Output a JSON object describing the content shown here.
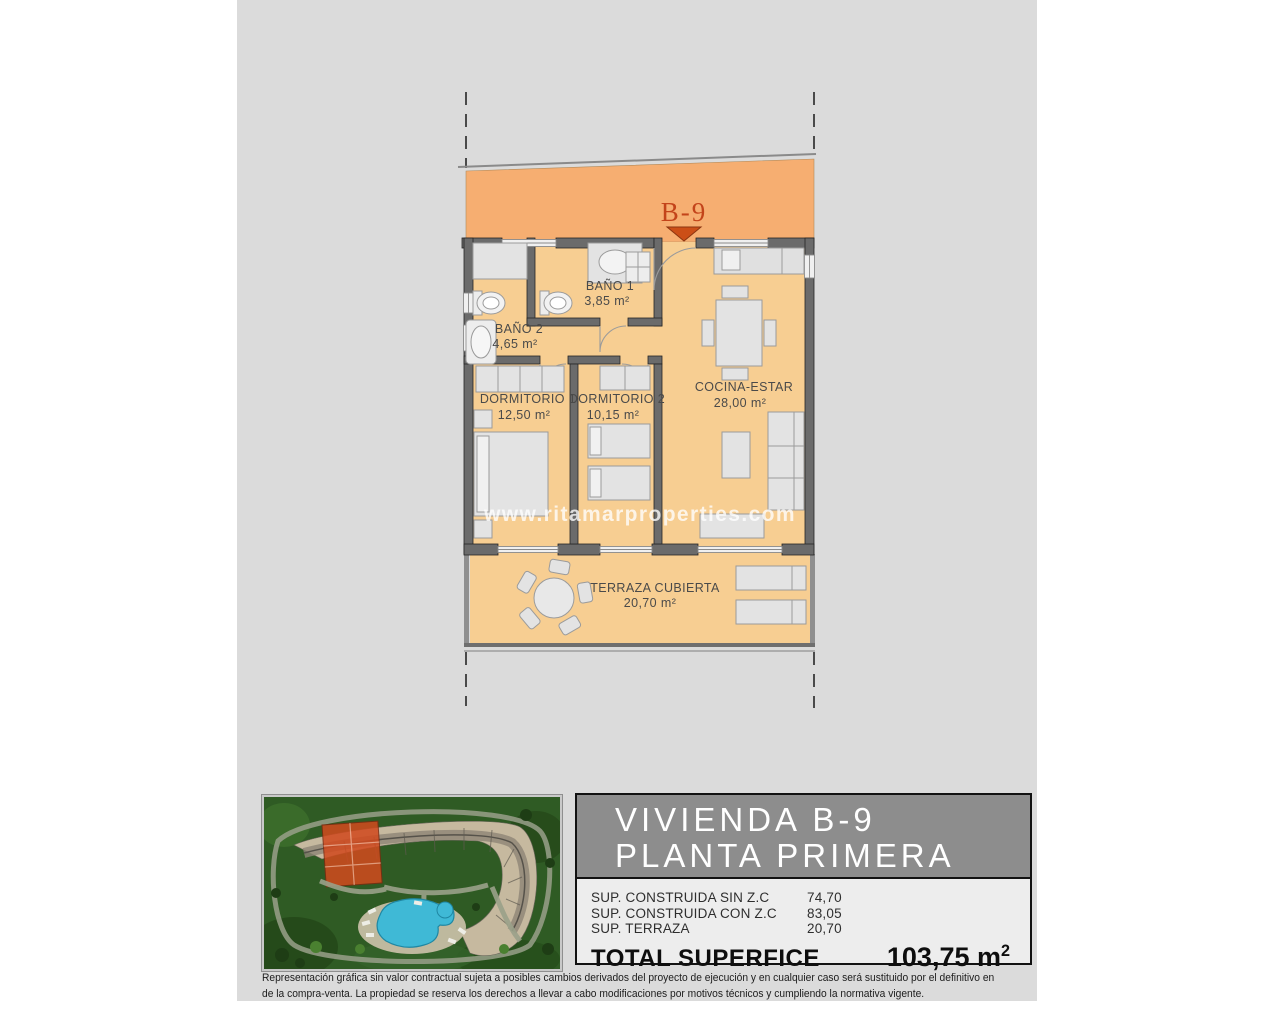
{
  "watermark": "www.ritamarproperties.com",
  "plan": {
    "unit_label": "B-9",
    "rooms": {
      "bano1": {
        "name": "BAÑO 1",
        "area": "3,85 m²"
      },
      "bano2": {
        "name": "BAÑO 2",
        "area": "4,65 m²"
      },
      "dorm1": {
        "name": "DORMITORIO 1",
        "area": "12,50 m²"
      },
      "dorm2": {
        "name": "DORMITORIO 2",
        "area": "10,15 m²"
      },
      "cocina": {
        "name": "COCINA-ESTAR",
        "area": "28,00 m²"
      },
      "terraza": {
        "name": "TERRAZA CUBIERTA",
        "area": "20,70 m²"
      }
    }
  },
  "info_panel": {
    "title_line1": "VIVIENDA B-9",
    "title_line2": "PLANTA PRIMERA",
    "rows": [
      {
        "label": "SUP. CONSTRUIDA SIN Z.C",
        "value": "74,70"
      },
      {
        "label": "SUP. CONSTRUIDA CON Z.C",
        "value": "83,05"
      },
      {
        "label": "SUP. TERRAZA",
        "value": "20,70"
      }
    ],
    "total_label": "TOTAL SUPERFICE",
    "total_value": "103,75 m",
    "total_value_exp": "2"
  },
  "disclaimer": {
    "line1": "Representación gráfica sin valor contractual sujeta a posibles cambios derivados del proyecto de ejecución y en cualquier caso será sustituido por el definitivo en",
    "line2": "de la compra-venta. La propiedad se reserva los derechos a llevar a cabo modificaciones por motivos técnicos y cumpliendo la normativa vigente."
  },
  "colors": {
    "paper": "#DBDBDB",
    "common_band": "#F6AE71",
    "floor": "#F7CE92",
    "wall": "#6B6B6B",
    "marker": "#C3441A",
    "panel_title_bg": "#8D8D8D",
    "highlight_block": "#D14A1E",
    "pool": "#3FB9D6",
    "grass": "#2F5B24"
  }
}
